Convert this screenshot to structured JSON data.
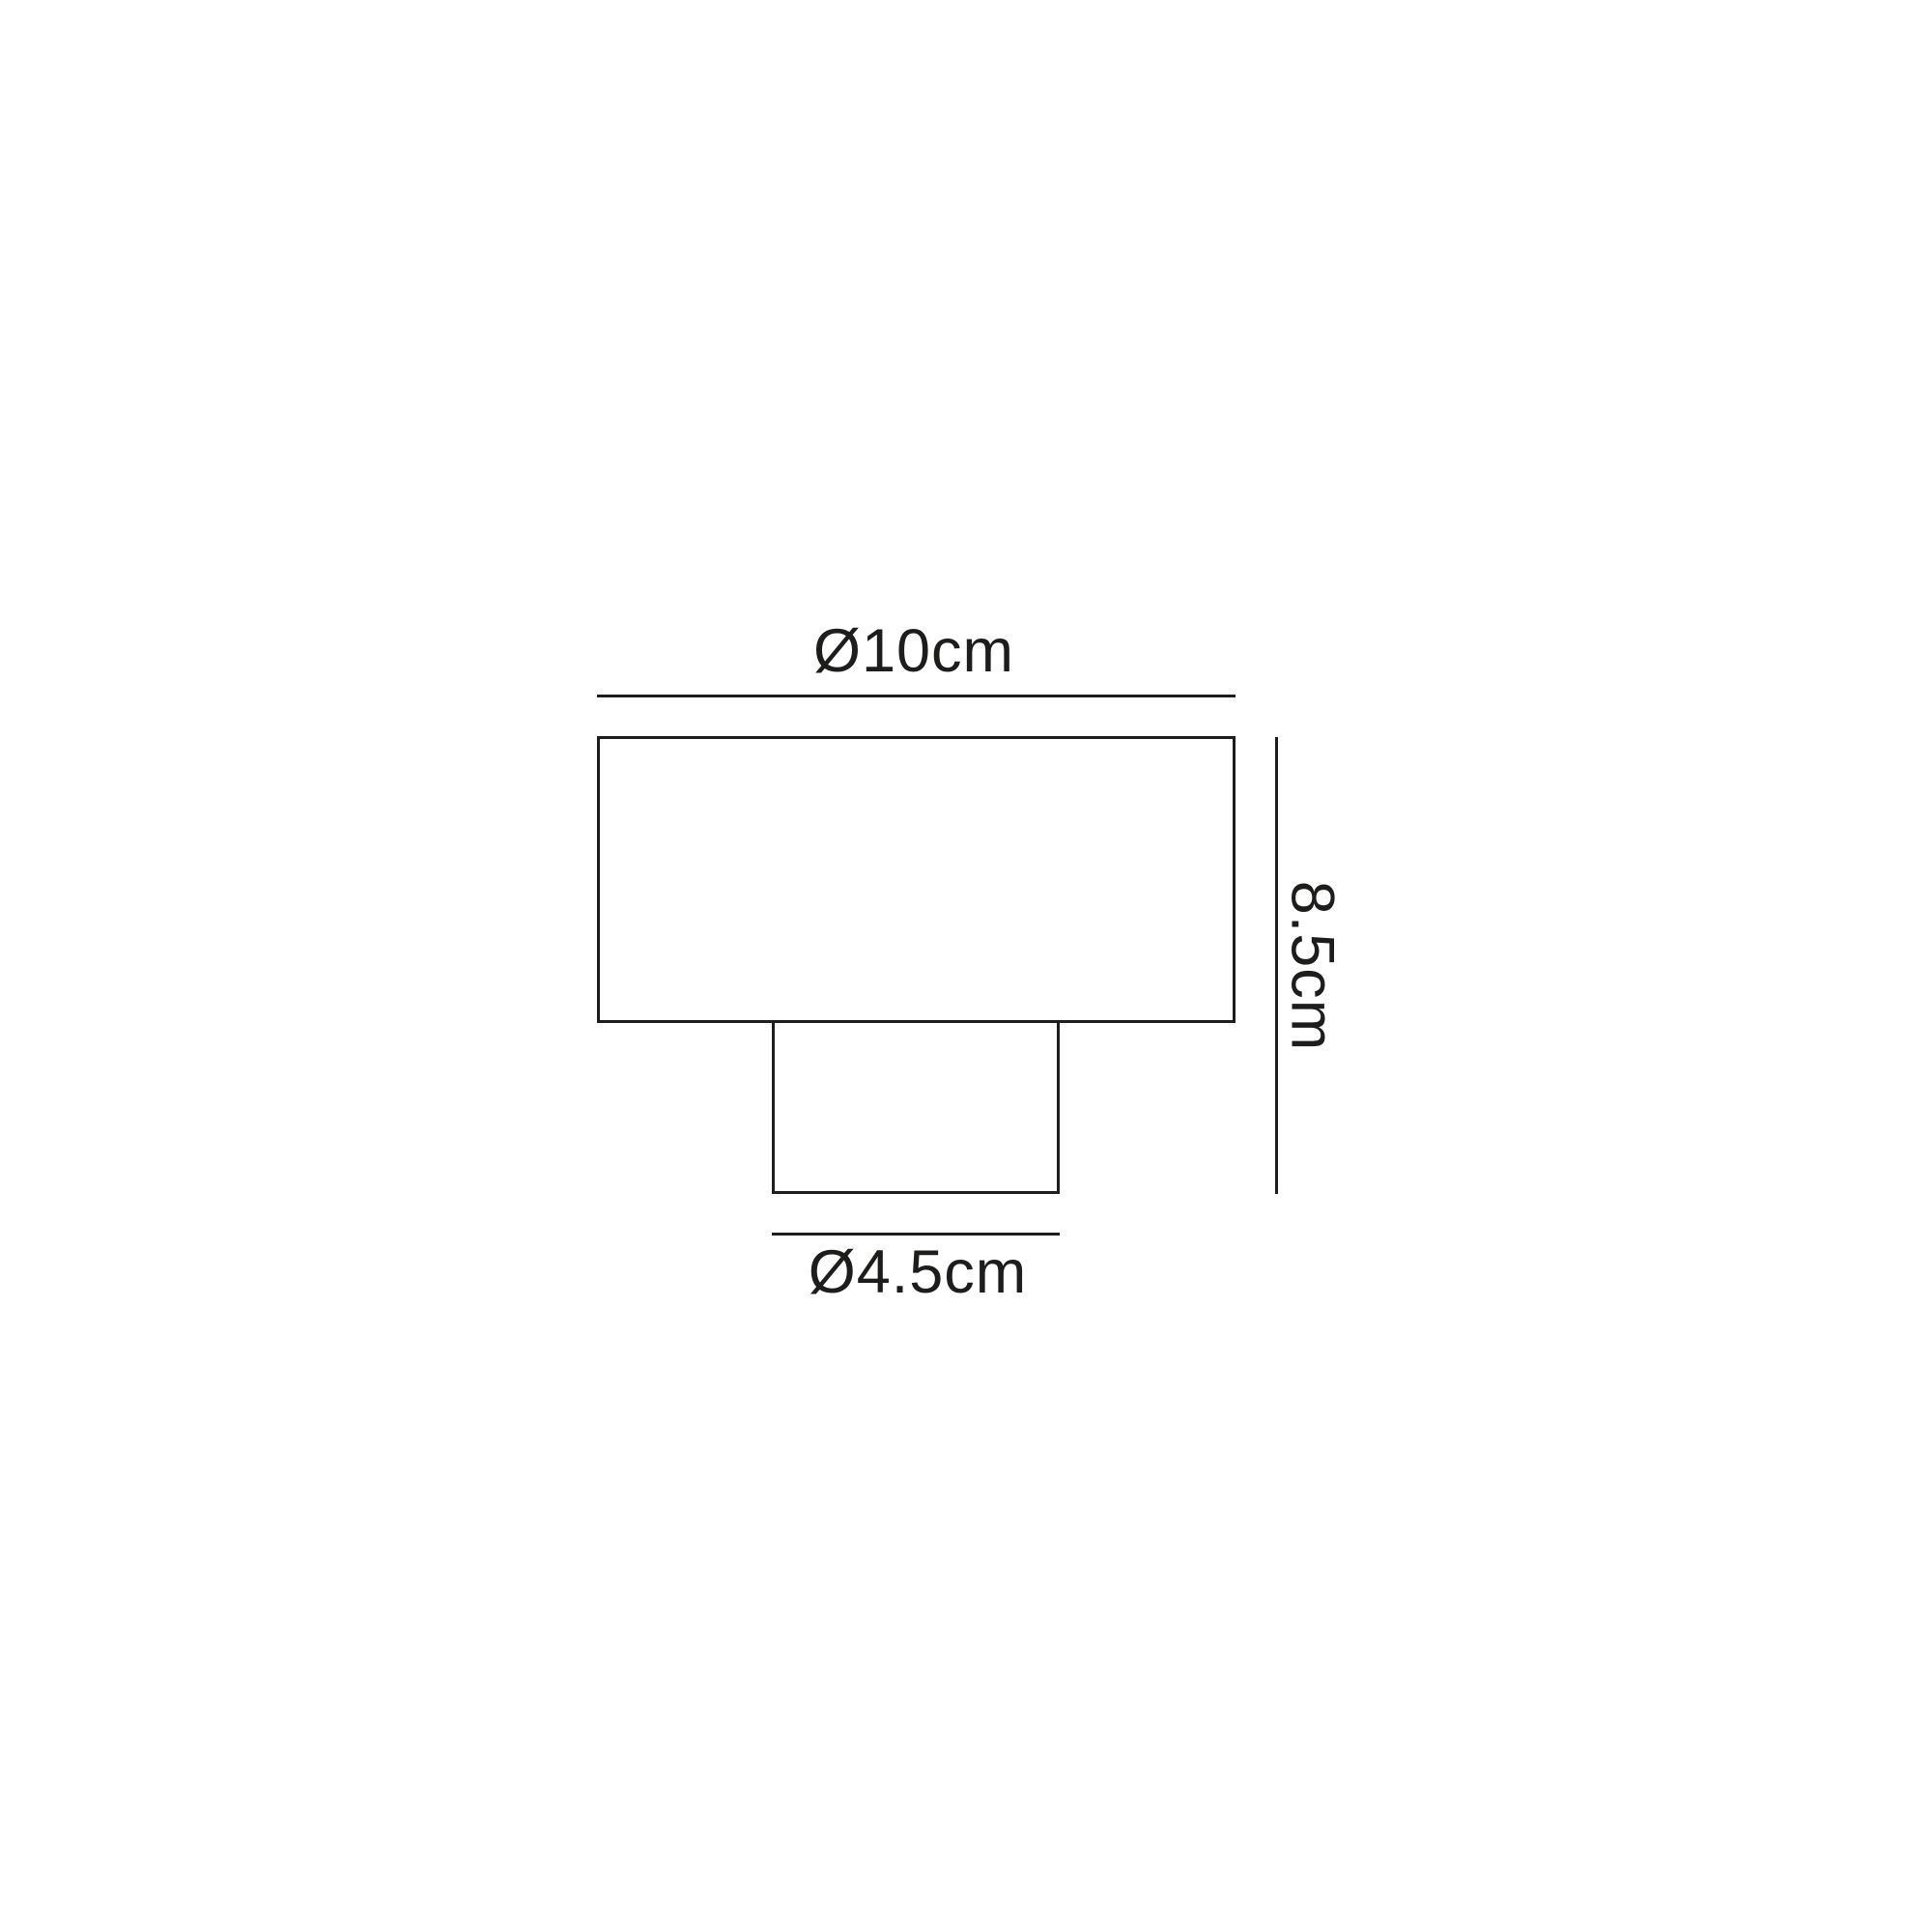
{
  "diagram": {
    "kind": "product-dimension-drawing",
    "top_dimension": "Ø10cm",
    "height_dimension": "8.5cm",
    "base_dimension": "Ø4.5cm",
    "colors": {
      "line": "#1d1d1b",
      "background": "#ffffff"
    }
  }
}
